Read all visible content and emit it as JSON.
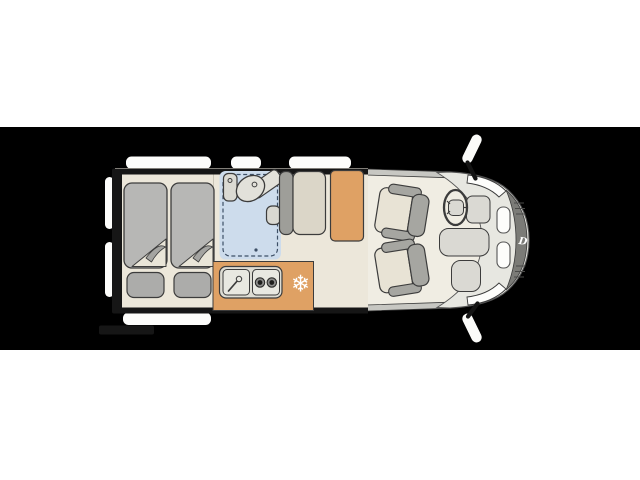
{
  "diagram": {
    "label": "Campervan floor plan, top view, cab at right",
    "page_background": "#ffffff",
    "band_color": "#000000"
  },
  "icons": {
    "fridge_snowflake": "❄",
    "brand_logo_letter": "D"
  },
  "areas": [
    "rear-twin-beds",
    "shower-bathroom-with-toilet-and-washbasin",
    "kitchenette-with-sink-and-two-burner-hob",
    "compressor-fridge-position",
    "bench-seat",
    "table-wardrobe",
    "two-swivel-cab-seats",
    "driver-cab-with-steering-wheel"
  ],
  "colors": {
    "band": "#000000",
    "living_floor": "#ece7da",
    "walls": "#161616",
    "cab_floor": "#f0ede3",
    "hood": "#e7e7e1",
    "bumper_band": "#c7c7c2",
    "grille_dark": "#7b7b77",
    "mattress": "#b7b7b5",
    "pillow": "#acacaa",
    "bathroom_blue": "#cddcec",
    "bathroom_dash": "#3d4f66",
    "counter_orange": "#dfa164",
    "fixture_gray": "#deddd4",
    "bench_frame": "#9e9e99",
    "bench_cushion": "#dbd6c8",
    "seat_cushion": "#e8e3d5",
    "seat_frame": "#a6a6a1",
    "accent_white": "#fdfdfb"
  }
}
